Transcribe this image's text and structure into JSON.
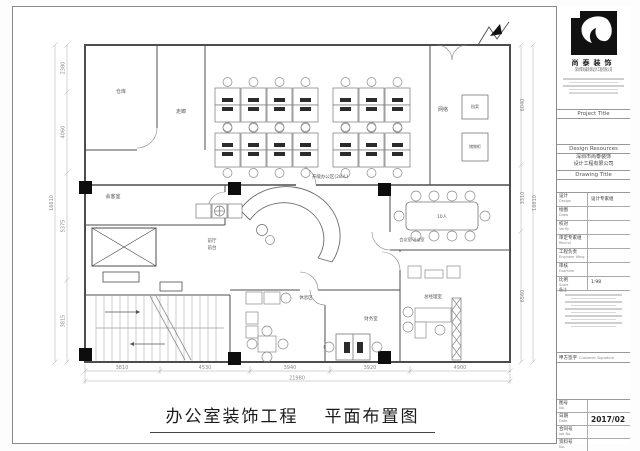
{
  "sheet": {
    "footer_title": {
      "part1": "办公室装饰工程",
      "part2": "平面布置图"
    }
  },
  "plan": {
    "rooms": {
      "storage": "仓库",
      "corridor": "走廊",
      "open_office": "开敞办公区(28人)",
      "network": "网络",
      "archive_cabinet": "档案",
      "storage_cabinet": "储物柜",
      "reception_room": "会客室",
      "front_hall": "前厅",
      "front_desk": "前台",
      "meeting_room": "会议室/洽谈室",
      "meeting_capacity": "10人",
      "rest_area": "休息区",
      "finance_room": "财务室",
      "gm_office": "总经理室"
    },
    "dimensions": {
      "bottom": [
        "3810",
        "4530",
        "3940",
        "3920",
        "4900"
      ],
      "bottom_total": "21980",
      "left": [
        "2380",
        "4060",
        "5375",
        "3815"
      ],
      "left_total": "16610",
      "right": [
        "6040",
        "3310",
        "6560"
      ],
      "right_total": "16610"
    }
  },
  "titleblock": {
    "brand": "尚泰装饰",
    "company_line1": "深圳市尚泰装饰设计工程有限公司",
    "project_title_label": "Project Title",
    "design_resources_label": "Design Resources",
    "client_line1": "深圳市尚泰装饰",
    "client_line2": "设计工程有限公司",
    "drawing_title_label": "Drawing Title",
    "rows": [
      {
        "cn": "设计",
        "en": "Design",
        "value": "设计专家组"
      },
      {
        "cn": "绘图",
        "en": "Draw",
        "value": ""
      },
      {
        "cn": "校对",
        "en": "Verify",
        "value": ""
      },
      {
        "cn": "审定专家组",
        "en": "Recind",
        "value": ""
      },
      {
        "cn": "工程负责",
        "en": "Engineer Wing",
        "value": ""
      },
      {
        "cn": "审核",
        "en": "Examine",
        "value": ""
      },
      {
        "cn": "比例",
        "en": "Scale",
        "value": "1:98"
      }
    ],
    "note_label": "备注",
    "signature_cn": "甲方签字",
    "signature_en": "Customer Signature",
    "bottom_rows": [
      {
        "cn": "图号",
        "en": "No.",
        "value": ""
      },
      {
        "cn": "日期",
        "en": "Date",
        "value": "2017/02"
      },
      {
        "cn": "合同号",
        "en": "Job No.",
        "value": ""
      },
      {
        "cn": "资料号",
        "en": "No.",
        "value": ""
      }
    ]
  }
}
